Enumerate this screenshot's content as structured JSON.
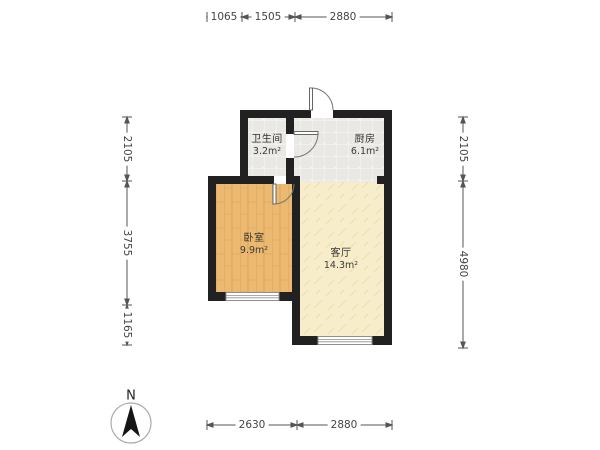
{
  "plan": {
    "rooms": [
      {
        "id": "bathroom",
        "name": "卫生间",
        "area": "3.2m²"
      },
      {
        "id": "kitchen",
        "name": "厨房",
        "area": "6.1m²"
      },
      {
        "id": "bedroom",
        "name": "卧室",
        "area": "9.9m²"
      },
      {
        "id": "living",
        "name": "客厅",
        "area": "14.3m²"
      }
    ],
    "dimensions": {
      "top": [
        "1065",
        "1505",
        "2880"
      ],
      "left": [
        "2105",
        "3755",
        "1165"
      ],
      "right": [
        "2105",
        "4980"
      ],
      "bottom": [
        "2630",
        "2880"
      ]
    },
    "compass": {
      "label": "N"
    },
    "colors": {
      "wall": "#212121",
      "tile_floor": "#e9e8e5",
      "wood_floor": "#ecb971",
      "living_floor": "#f8edca",
      "dimension_line": "#555555"
    }
  }
}
